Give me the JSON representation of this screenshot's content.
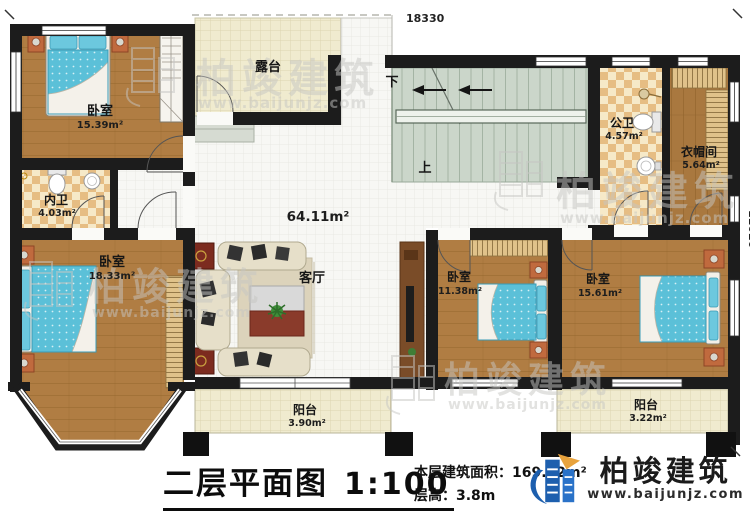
{
  "dimensions": {
    "top": "18330",
    "right": "11020"
  },
  "rooms": {
    "bedroom_tl": {
      "label": "卧室",
      "area": "15.39m²"
    },
    "terrace": {
      "label": "露台"
    },
    "bath_inner": {
      "label": "内卫",
      "area": "4.03m²"
    },
    "bath_public": {
      "label": "公卫",
      "area": "4.57m²"
    },
    "cloakroom": {
      "label": "衣帽间",
      "area": "5.64m²"
    },
    "bedroom_bl": {
      "label": "卧室",
      "area": "18.33m²"
    },
    "hall": {
      "area": "64.11m²"
    },
    "living": {
      "label": "客厅"
    },
    "bedroom_bm": {
      "label": "卧室",
      "area": "11.38m²"
    },
    "bedroom_br": {
      "label": "卧室",
      "area": "15.61m²"
    },
    "balcony_left": {
      "label": "阳台",
      "area": "3.90m²"
    },
    "balcony_right": {
      "label": "阳台",
      "area": "3.22m²"
    }
  },
  "stairs": {
    "down": "下",
    "up": "上"
  },
  "footer": {
    "title": "二层平面图",
    "scale": "1:100",
    "area_line": "本层建筑面积：169.12m²",
    "floor_height_line": "层高：3.8m"
  },
  "brand": {
    "name": "柏竣建筑",
    "url": "www.baijunjz.com"
  },
  "watermark": {
    "name": "柏竣建筑",
    "url": "www.baijunjz.com"
  },
  "colors": {
    "wall": "#1c1c1c",
    "wood": "#b07d43",
    "tile_cream": "#f0ebcf",
    "tile_white": "#f7f7f4",
    "checker_light": "#f6e9c8",
    "checker_dark": "#e6bd83",
    "stairs": "#cbd6ca",
    "bed_blue": "#5bc0d8",
    "brand_blue": "#1d5fae",
    "brand_orange": "#e8a33d"
  }
}
